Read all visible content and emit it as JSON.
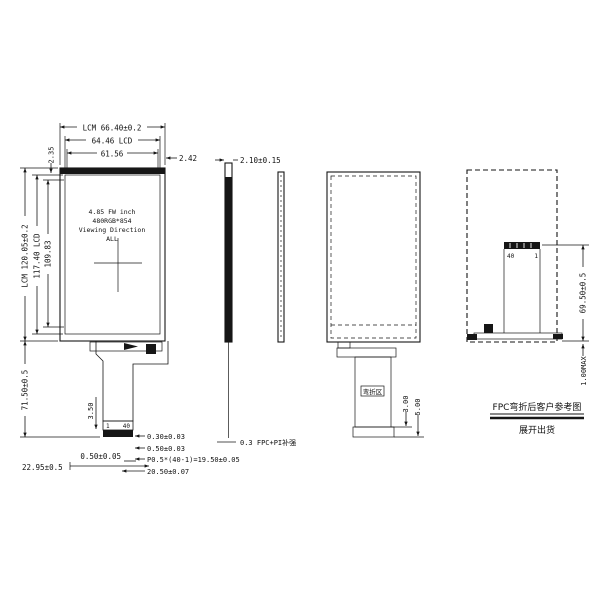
{
  "front_view": {
    "spec": {
      "line1": "4.85 FW inch",
      "line2": "480RGB*854",
      "line3": "Viewing Direction",
      "line4": "ALL"
    },
    "fpc_pin_first": "1",
    "fpc_pin_last": "40"
  },
  "dimensions": {
    "lcm_width": "LCM 66.40±0.2",
    "lcd_width": "64.46 LCD",
    "aa_width": "61.56",
    "right_border": "2.42",
    "top_border": "2.35",
    "lcm_height": "LCM 120.05±0.2",
    "lcd_height": "117.40 LCD",
    "aa_height": "109.83",
    "fpc_length": "71.50±0.5",
    "fpc_tail": "3.50",
    "thickness": "2.10±0.15",
    "fpc_edge_offset": "0.50±0.05",
    "fpc_position": "22.95±0.5",
    "pin_pitch_a": "0.30±0.03",
    "pin_pitch_b": "0.50±0.03",
    "pin_span": "P0.5*(40-1)=19.50±0.05",
    "connector_width": "20.50±0.07",
    "fpc_note": "0.3 FPC+PI补强",
    "bend_a": "3.00",
    "bend_b": "5.00",
    "fold_height": "69.50±0.5",
    "fold_gap": "1.00MAX"
  },
  "back_view": {
    "bend_zone_label": "弯折区",
    "pin_last": "40",
    "pin_first": "1"
  },
  "notes": {
    "folded_note": "FPC弯折后客户参考图",
    "unfolded_note": "展开出货"
  }
}
